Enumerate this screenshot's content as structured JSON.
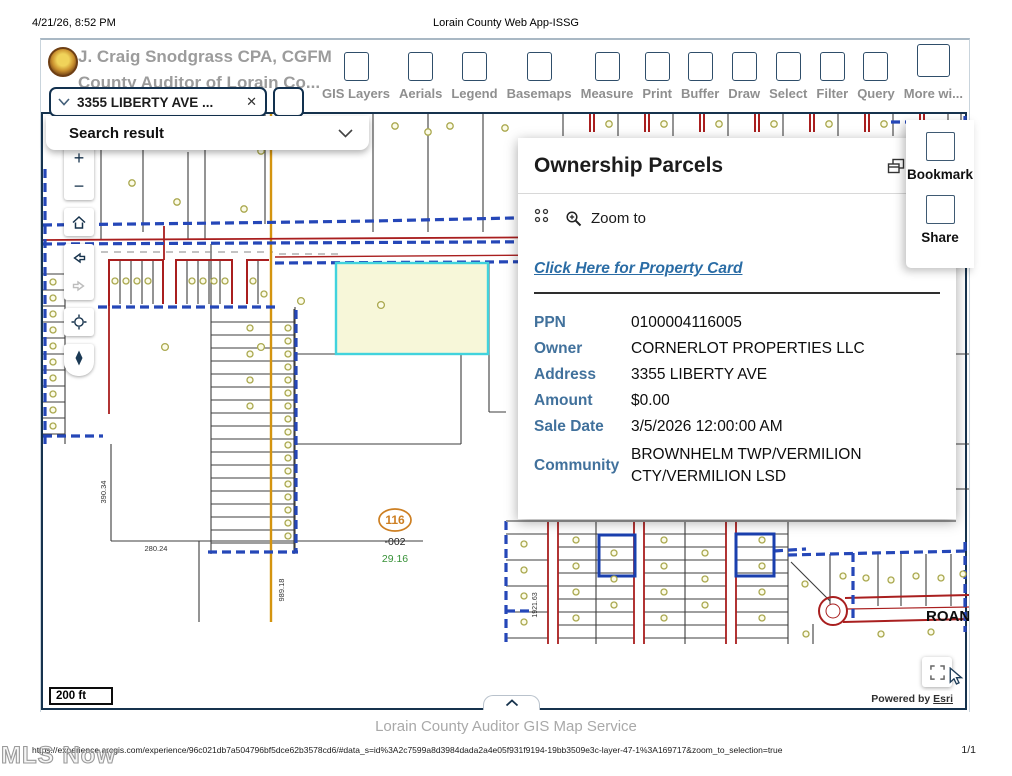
{
  "page": {
    "datetime": "4/21/26, 8:52 PM",
    "doc_title": "Lorain County Web App-ISSG",
    "map_caption": "Lorain County Auditor GIS Map Service",
    "url": "https://experience.arcgis.com/experience/96c021db7a504796bf5dce62b3578cd6/#data_s=id%3A2c7599a8d3984dada2a4e05f931f9194-19bb3509e3c-layer-47-1%3A169717&zoom_to_selection=true",
    "page_indicator": "1/1",
    "watermark": "MLS Now"
  },
  "icons": {
    "close": "✕",
    "plus": "+",
    "minus": "−"
  },
  "header": {
    "title": "J. Craig Snodgrass CPA, CGFM",
    "subtitle": "County Auditor of Lorain Co...",
    "search": {
      "value": "3355 LIBERTY AVE ..."
    },
    "toolbar": [
      {
        "label": "GIS Layers"
      },
      {
        "label": "Aerials"
      },
      {
        "label": "Legend"
      },
      {
        "label": "Basemaps"
      },
      {
        "label": "Measure"
      },
      {
        "label": "Print"
      },
      {
        "label": "Buffer"
      },
      {
        "label": "Draw"
      },
      {
        "label": "Select"
      },
      {
        "label": "Filter"
      },
      {
        "label": "Query"
      },
      {
        "label": "More wi..."
      }
    ]
  },
  "search_result": {
    "label": "Search result"
  },
  "side_menu": {
    "items": [
      {
        "label": "Bookmark"
      },
      {
        "label": "Share"
      }
    ]
  },
  "panel": {
    "title": "Ownership Parcels",
    "zoom_to": "Zoom to",
    "link": "Click Here for Property Card",
    "fields": [
      {
        "label": "PPN",
        "value": "0100004116005"
      },
      {
        "label": "Owner",
        "value": "CORNERLOT PROPERTIES LLC"
      },
      {
        "label": "Address",
        "value": "3355 LIBERTY AVE"
      },
      {
        "label": "Amount",
        "value": "$0.00"
      },
      {
        "label": "Sale Date",
        "value": "3/5/2026 12:00:00 AM"
      },
      {
        "label": "Community",
        "value": "BROWNHELM TWP/VERMILION CTY/VERMILION LSD"
      }
    ]
  },
  "map": {
    "scale_label": "200 ft",
    "powered_by_prefix": "Powered by",
    "powered_by_link": "Esri",
    "labels": {
      "parcel_number": "116",
      "parcel_suffix": "-002",
      "parcel_acres": "29.16",
      "dim_left": "390.34",
      "dim_bottom": "280.24",
      "dim_road": "989.18",
      "dim_right": "1921.63",
      "street_name": "ROAN"
    },
    "colors": {
      "parcel_line": "#3d3d3d",
      "road_red": "#a91f1f",
      "boundary_blue": "#2547b8",
      "road_gold": "#d4940f",
      "selection_fill": "#f7f7d9",
      "selection_border": "#41d3dd",
      "marker_olive": "#aaa84f",
      "map_border": "#16334e"
    }
  }
}
